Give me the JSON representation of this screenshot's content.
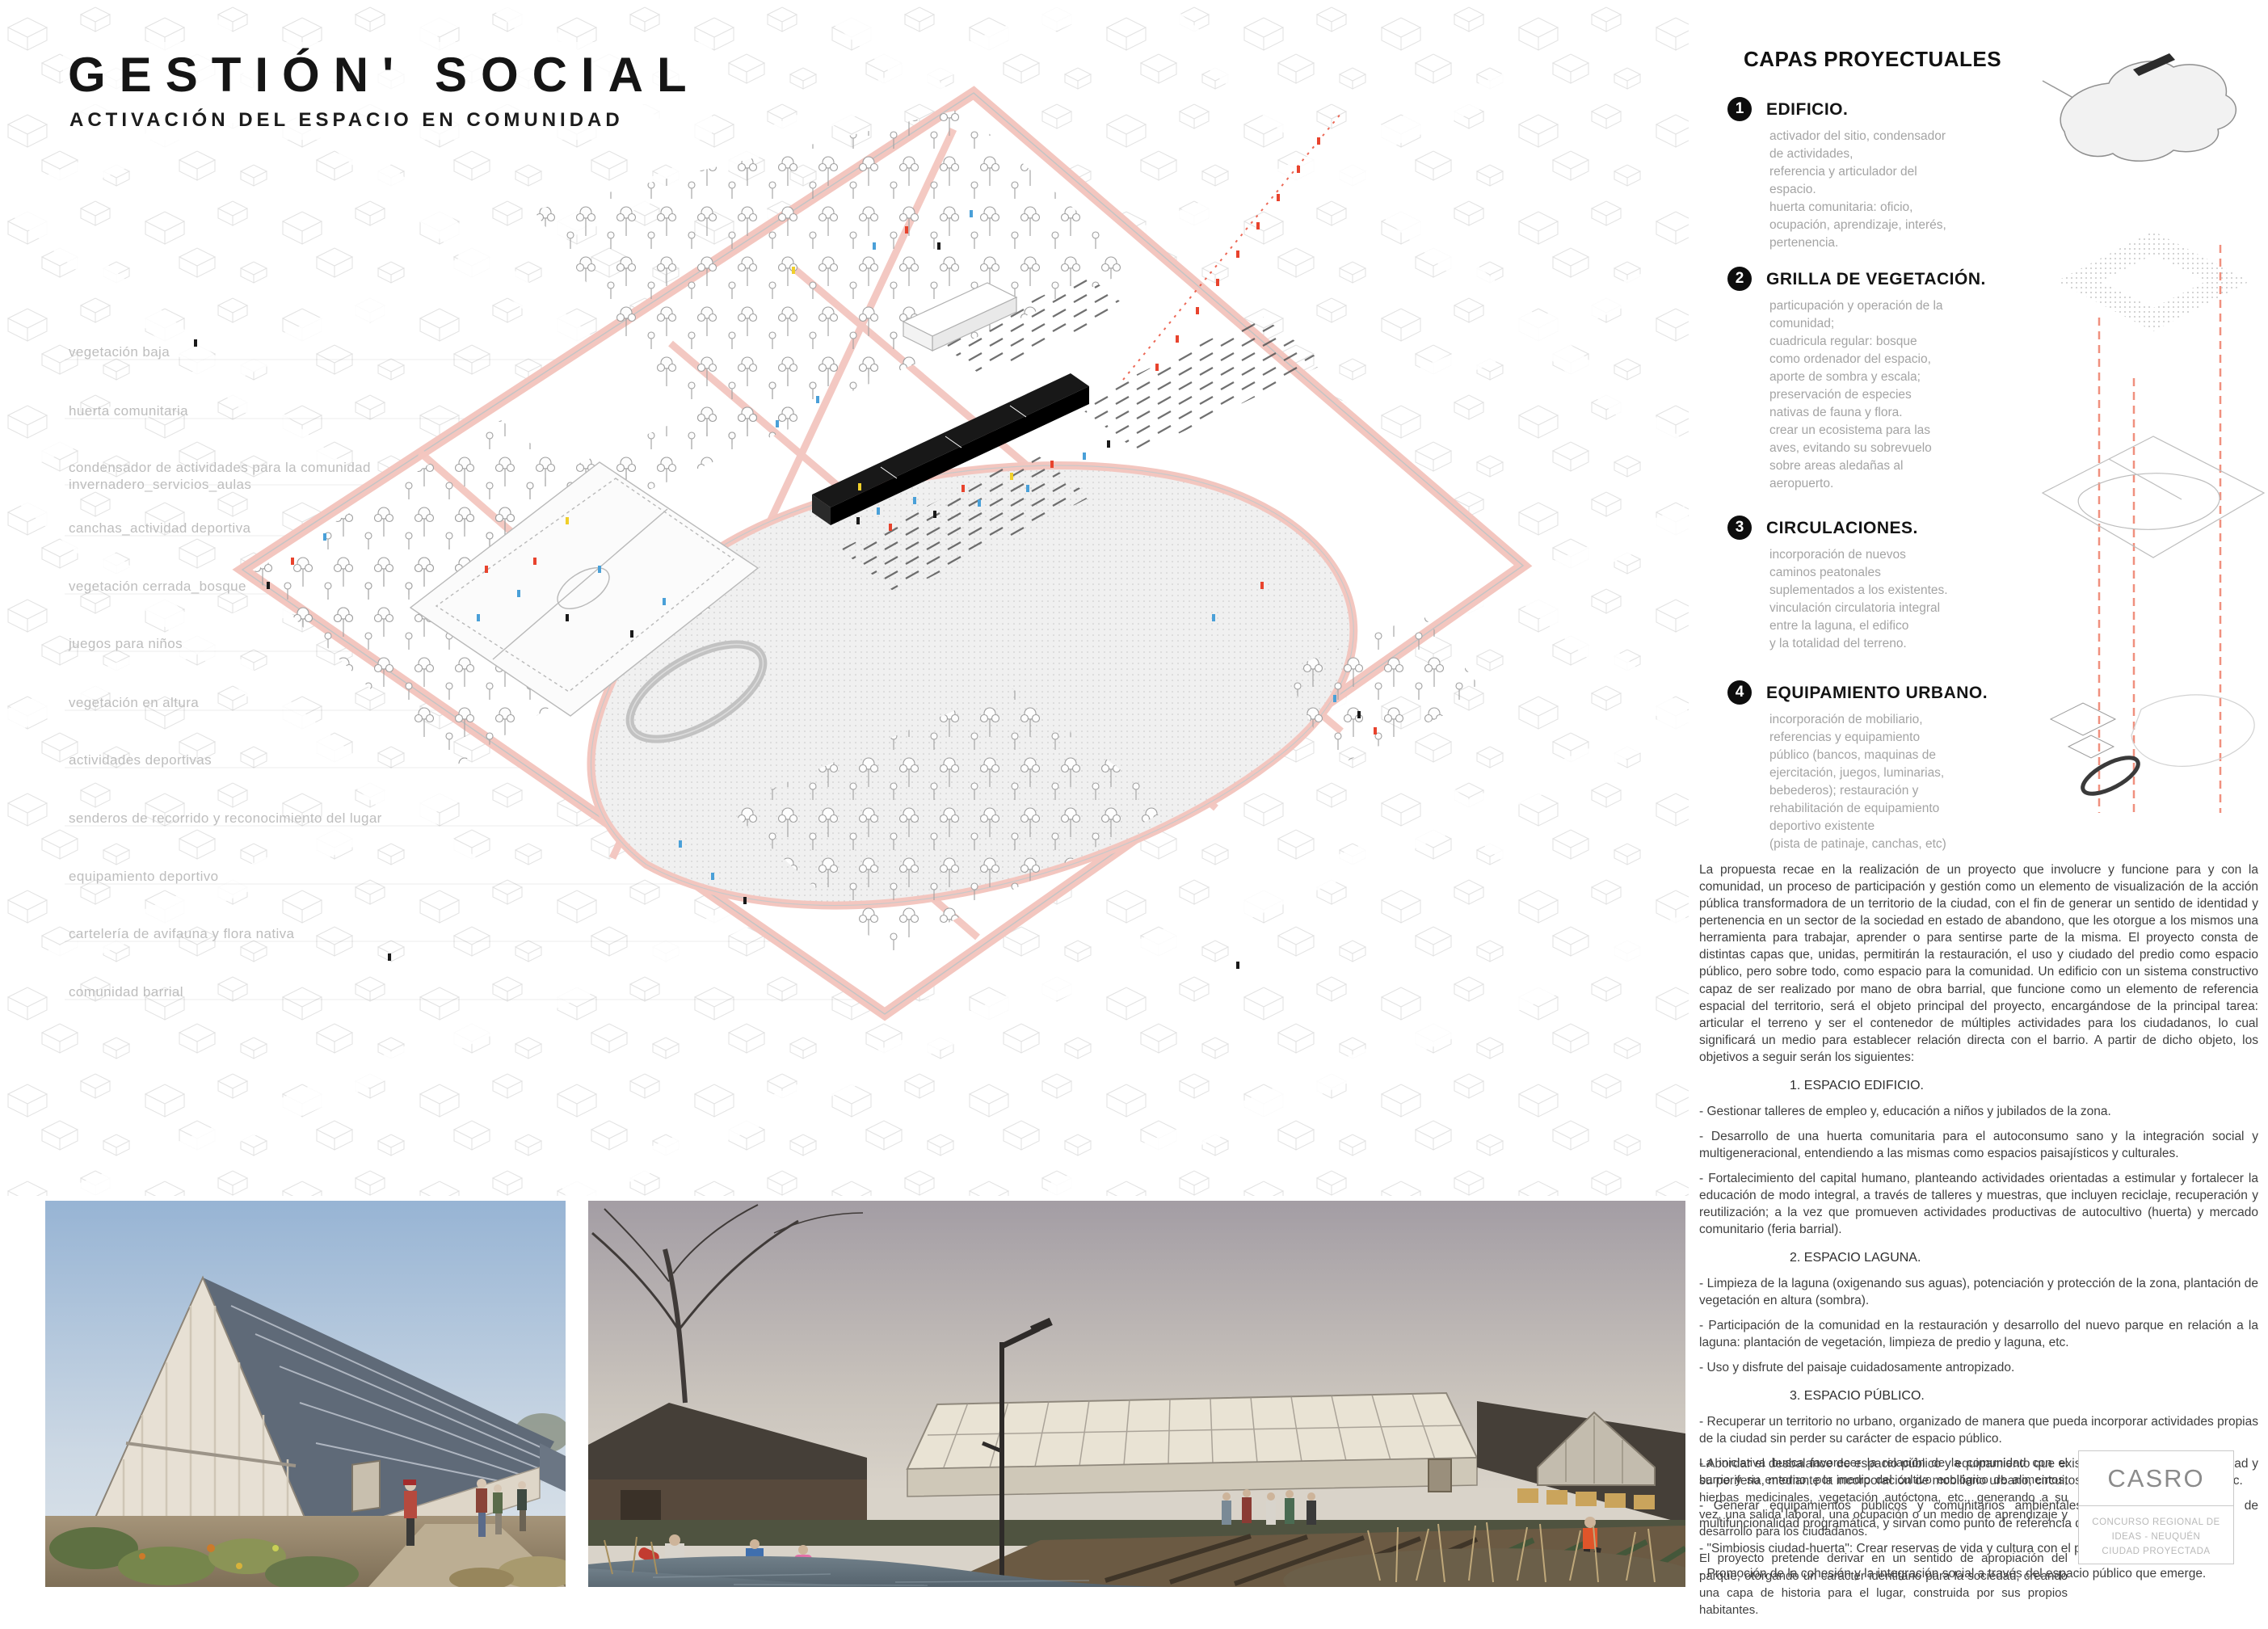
{
  "board": {
    "title": "GESTIÓN' SOCIAL",
    "subtitle": "ACTIVACIÓN DEL ESPACIO  EN COMUNIDAD"
  },
  "plan_labels": [
    "vegetación baja",
    "huerta comunitaria",
    "condensador de actividades para la comunidad\ninvernadero_servicios_aulas",
    "canchas_actividad deportiva",
    "vegetación cerrada_bosque",
    "juegos para niños",
    "vegetación en altura",
    "actividades deportivas",
    "senderos de recorrido y reconocimiento del lugar",
    "equipamiento deportivo",
    "cartelería de avifauna y flora nativa",
    "comunidad barrial"
  ],
  "capas": {
    "heading": "CAPAS PROYECTUALES",
    "items": [
      {
        "num": "1",
        "title": "EDIFICIO.",
        "desc": "activador del sitio, condensador\nde actividades,\nreferencia y articulador del\nespacio.\nhuerta comunitaria: oficio,\nocupación, aprendizaje, interés,\npertenencia."
      },
      {
        "num": "2",
        "title": "GRILLA DE VEGETACIÓN.",
        "desc": "particupación y operación de la\ncomunidad;\ncuadricula regular: bosque\ncomo ordenador del espacio,\naporte de sombra y escala;\npreservación de especies\nnativas de fauna y flora.\ncrear un ecosistema para las\naves, evitando su sobrevuelo\nsobre areas aledañas al\naeropuerto."
      },
      {
        "num": "3",
        "title": "CIRCULACIONES.",
        "desc": "incorporación de nuevos\ncaminos peatonales\nsuplementados a los existentes.\nvinculación circulatoria integral\nentre la laguna, el edifico\ny la totalidad del terreno."
      },
      {
        "num": "4",
        "title": "EQUIPAMIENTO URBANO.",
        "desc": "incorporación de mobiliario,\nreferencias y equipamiento\npúblico (bancos, maquinas de\nejercitación, juegos, luminarias,\nbebederos); restauración y\nrehabilitación de equipamiento\ndeportivo existente\n(pista de patinaje, canchas, etc)"
      }
    ]
  },
  "memoria": {
    "intro": "La propuesta recae en la realización de un proyecto que involucre y funcione para y con la comunidad, un proceso de participación y gestión como un elemento de visualización de la acción pública transformadora de un territorio de la ciudad, con el fin de generar un sentido de identidad y pertenencia en un sector de la sociedad en estado de abandono, que les otorgue a los mismos una herramienta para trabajar, aprender o para sentirse parte de la misma. El proyecto consta de distintas capas que, unidas, permitirán la restauración, el uso y ciudado del predio como espacio público, pero sobre todo, como espacio para la comunidad. Un edificio con un sistema constructivo capaz de ser realizado por mano de obra barrial, que funcione como un elemento de referencia espacial del territorio, será el objeto principal del proyecto, encargándose de la principal tarea: articular el terreno y ser el contenedor de múltiples actividades para los ciudadanos, lo cual significará un medio para establecer relación directa con el barrio. A partir de dicho objeto, los objetivos a seguir serán los siguientes:",
    "sections": [
      {
        "heading": "1.  ESPACIO EDIFICIO.",
        "bullets": [
          "- Gestionar talleres de empleo y, educación a niños y jubilados de la zona.",
          "- Desarrollo de una huerta comunitaria para el autoconsumo sano y la integración social y multigeneracional, entendiendo a las mismas como espacios paisajísticos y culturales.",
          "- Fortalecimiento del capital humano, planteando actividades orientadas a estimular y fortalecer la educación de modo integral, a través de talleres y muestras, que incluyen reciclaje, recuperación y reutilización; a la vez que promueven actividades productivas de autocultivo (huerta) y mercado comunitario (feria barrial)."
        ]
      },
      {
        "heading": "2.  ESPACIO LAGUNA.",
        "bullets": [
          "- Limpieza de la laguna (oxigenando sus aguas), potenciación y protección de la zona, plantación de vegetación en altura (sombra).",
          "- Participación de la comunidad en la restauración y desarrollo del nuevo parque en relación a la laguna: plantación de vegetación, limpieza de predio y laguna, etc.",
          "- Uso y disfrute del paisaje cuidadosamente antropizado."
        ]
      },
      {
        "heading": "3.  ESPACIO PÚBLICO.",
        "bullets": [
          "- Recuperar un territorio no urbano, organizado de manera que pueda incorporar actividades propias de la ciudad sin perder su carácter de espacio público.",
          "- Abordar el desbalance de espacio público y equipamiento que existe entre el centro de la ciudad y su periferia, mediante la incorporación de mobiliario urbano, circuitos de recorrido, luminarias, etc.",
          "- Generar equipamientos públicos y comunitarios ambientales, que doten al territorio de multifuncionalidad programática, y sirvan como punto de referencia de la población barrial.",
          "- \"Simbiosis ciudad-huerta\": Crear reservas de vida y cultura con el parque.",
          "- Promoción de la cohesión y la integración social a través del espacio público que emerge."
        ]
      }
    ],
    "closing": [
      "La iniciativa busca favorecer la relación de la comunidad con el barrio y su entorno, por medio del cultivo ecológico de alimentos, hierbas medicinales, vegetación autóctona, etc., generando a su vez, una salida laboral, una ocupación o un medio de aprendizaje y desarrollo para los ciudadanos.",
      "El proyecto pretende derivar en un sentido de apropiación del parque, otorgando un carácter identitario para la sociedad, creando una capa de historia para el lugar,  construida por sus propios habitantes."
    ]
  },
  "footer_box": {
    "brand": "CASRO",
    "competition": "CONCURSO REGIONAL DE IDEAS - NEUQUÉN\nCIUDAD PROYECTADA"
  },
  "accent_colors": {
    "path_pink": "#f3c6bf",
    "people_red": "#e8432d",
    "people_blue": "#4aa0d8",
    "people_yellow": "#f0cf2a",
    "dashed_guide": "#f0907e"
  }
}
